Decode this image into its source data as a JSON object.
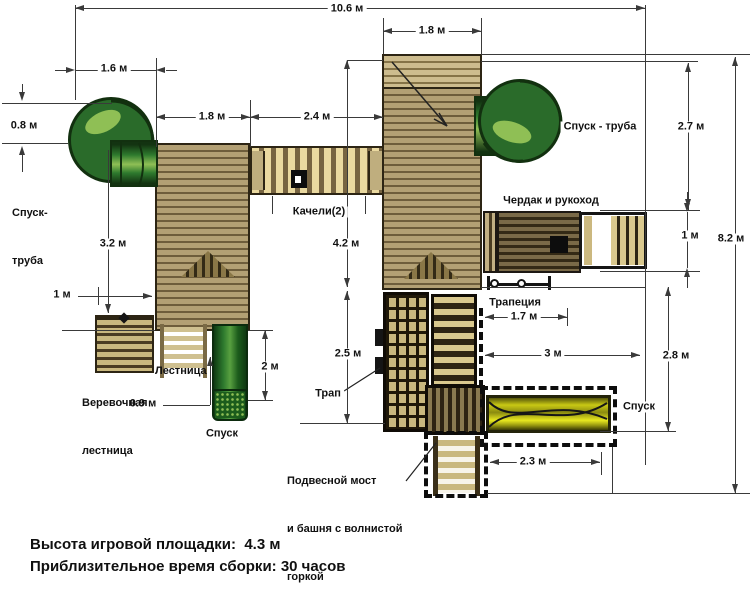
{
  "labels": {
    "tube_left_line1": "Спуск-",
    "tube_left_line2": "труба",
    "tube_right": "Спуск - труба",
    "swings": "Качели(2)",
    "loft": "Чердак и рукоход",
    "trapeze": "Трапеция",
    "rope_line1": "Веревочная",
    "rope_line2": "лестница",
    "ladder": "Лестница",
    "slide_left": "Спуск",
    "ramp": "Трап",
    "slide_wavy": "Спуск",
    "bridge_line1": "Подвесной мост",
    "bridge_line2": "и башня с волнистой",
    "bridge_line3": "горкой"
  },
  "dims": {
    "total_w": "10.6 м",
    "main_tower_w": "1.8 м",
    "spiral_w": "1.6 м",
    "tube_exit": "0.8 м",
    "left_tower_w": "1.8 м",
    "swing_span": "2.4 м",
    "right_drop": "2.7 м",
    "total_h": "8.2 м",
    "loft_h": "1 м",
    "left_tower_h": "3.2 м",
    "left_gap": "1 м",
    "main_tower_h": "4.2 м",
    "ramp_h": "2.5 м",
    "trapeze_w": "1.7 м",
    "loft_span": "3 м",
    "lower_h": "2.8 м",
    "slide_h": "2 м",
    "slide_w": "0.9 м",
    "wavy_len": "2.3 м"
  },
  "footer": {
    "line1": "Высота игровой площадки:  4.3 м",
    "line2": "Приблизительное время сборки: 30 часов"
  },
  "colors": {
    "wood_light": "#b3a074",
    "wood_dark": "#6e5d3b",
    "green_slide": "#2a6b2a",
    "yellow_slide": "#c9c914",
    "line": "#3a3a3a"
  }
}
